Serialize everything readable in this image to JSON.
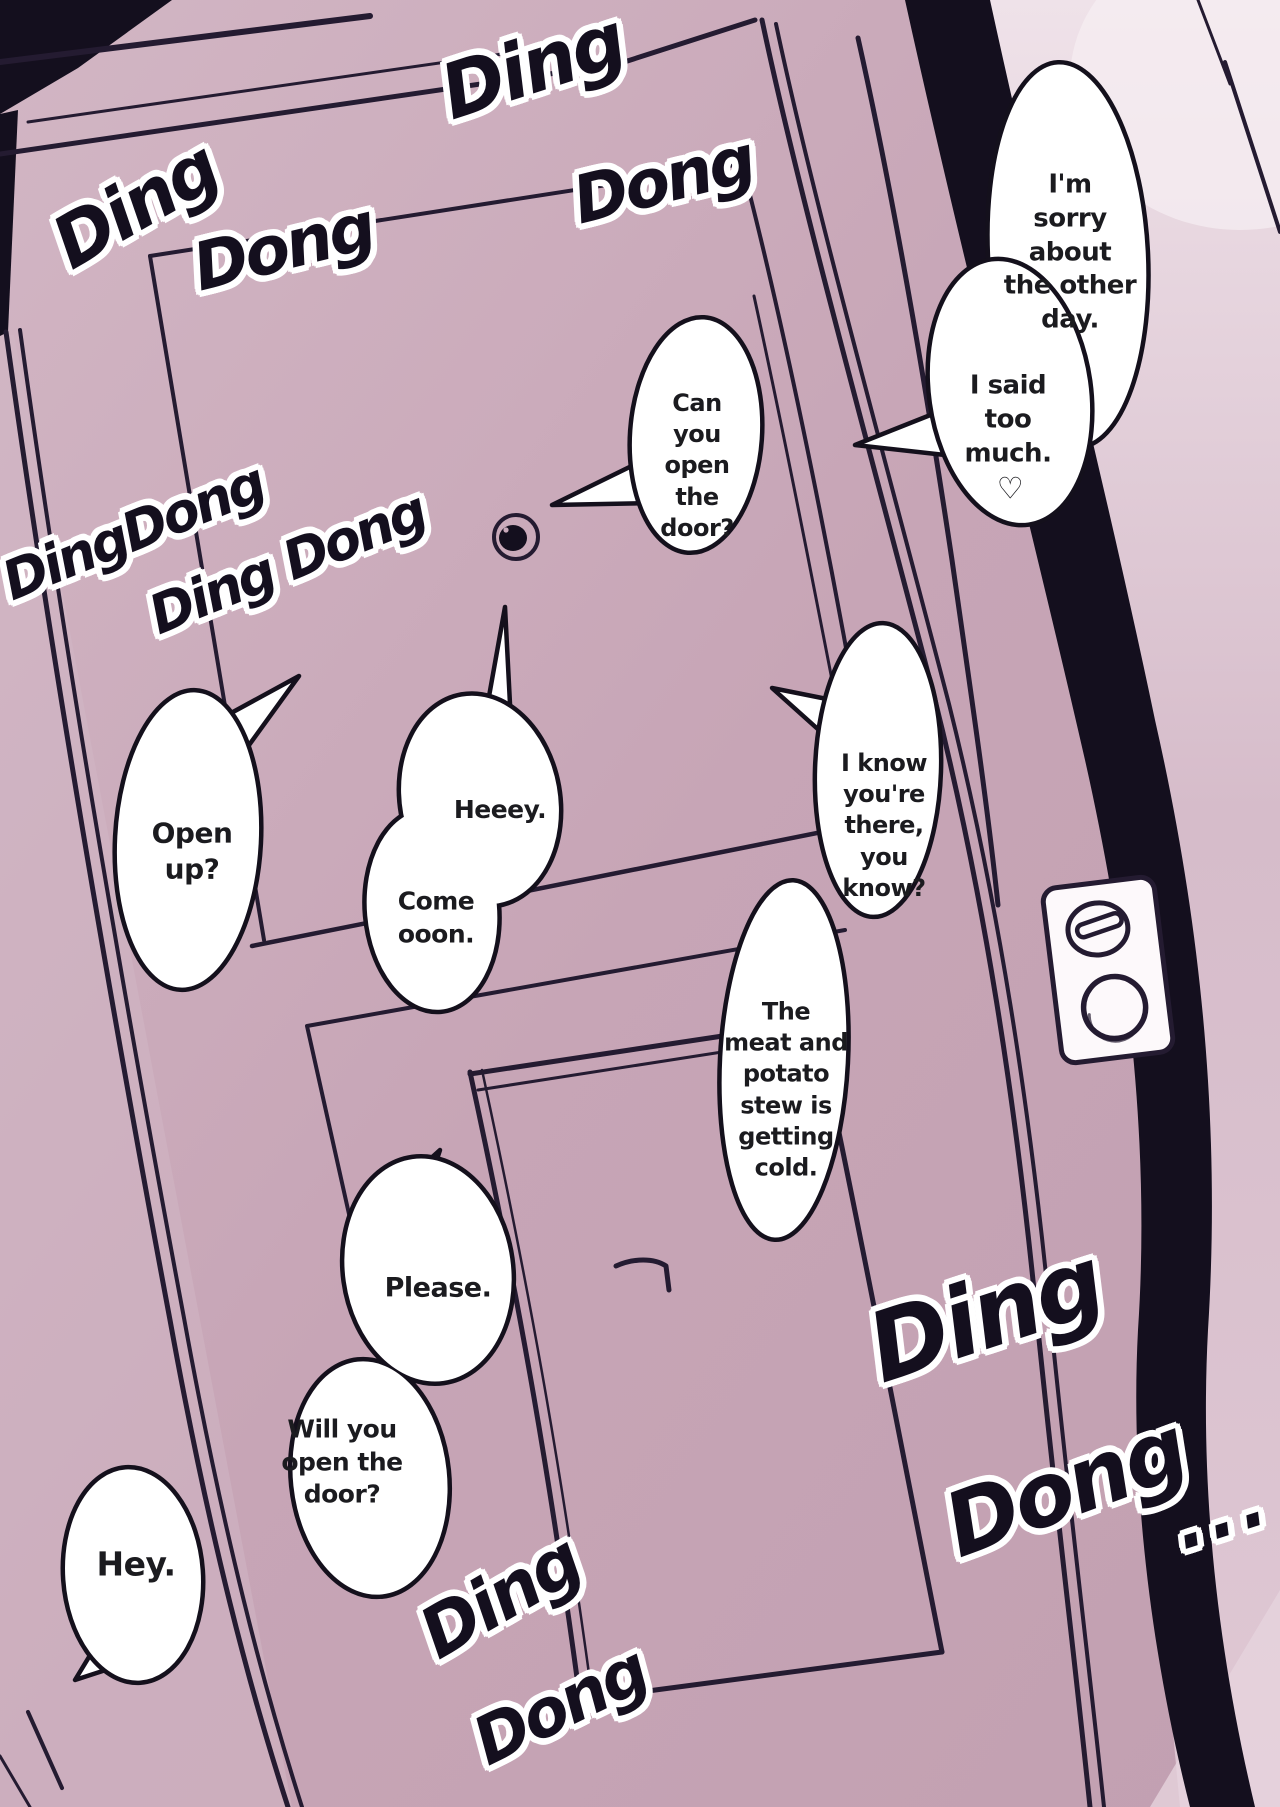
{
  "colors": {
    "page_background": "#c7a5b6",
    "wall_light": "#e7d7e0",
    "ink_black": "#140f1e",
    "line_dark": "#241b31",
    "bubble_fill": "#ffffff",
    "bubble_stroke": "#14101c",
    "text_color": "#1b1b1f"
  },
  "sfx": {
    "top_left_ding": "Ding",
    "top_left_dong": "Dong",
    "top_center_ding": "Ding",
    "top_center_dong": "Dong",
    "mid_left_dingdong": "DingDong",
    "mid_left_ding_dong": "Ding Dong",
    "bottom_center_ding": "Ding",
    "bottom_center_dong": "Dong",
    "bottom_right_ding": "Ding",
    "bottom_right_dong": "Dong",
    "bottom_right_ellipsis": "..."
  },
  "bubbles": {
    "sorry": "I'm\nsorry\nabout\nthe other\nday.",
    "said_too_much": "I said\ntoo\nmuch.",
    "heart": "♡",
    "can_you_open": "Can\nyou\nopen\nthe\ndoor?",
    "open_up": "Open\nup?",
    "heeey": "Heeey.",
    "come_ooon": "Come\nooon.",
    "i_know": "I know\nyou're\nthere,\nyou\nknow?",
    "stew": "The\nmeat and\npotato\nstew is\ngetting\ncold.",
    "please": "Please.",
    "will_you_open": "Will you\nopen the\ndoor?",
    "hey": "Hey."
  }
}
